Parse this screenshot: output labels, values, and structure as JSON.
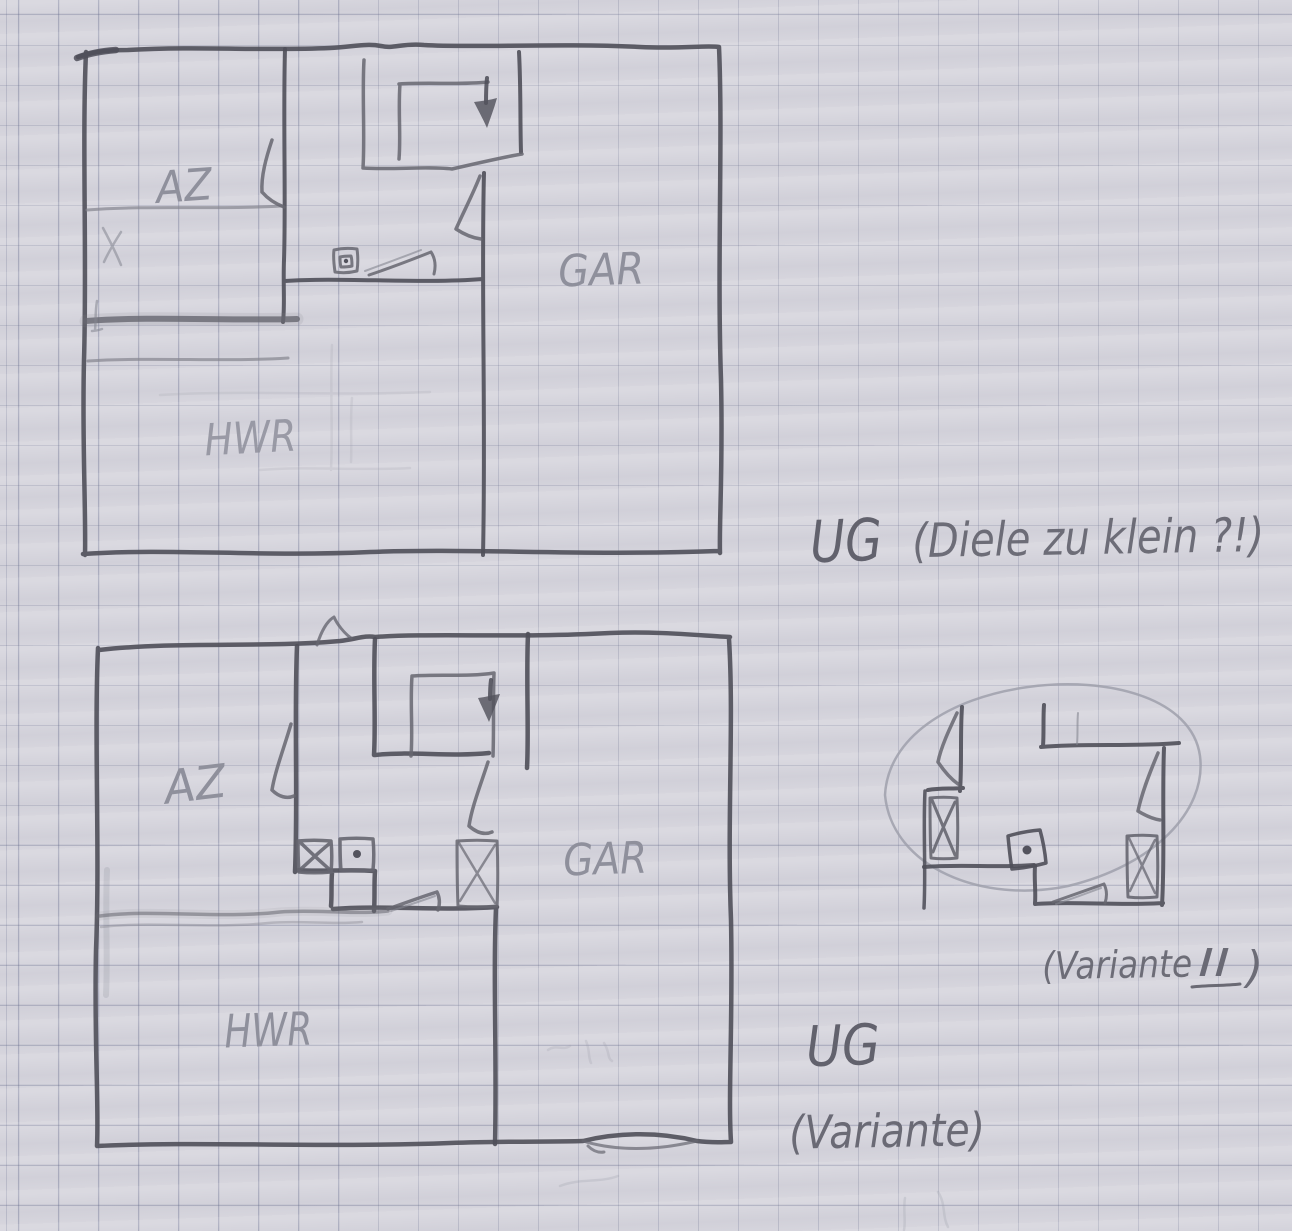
{
  "palette": {
    "paper": "#d6d5dd",
    "grid_line": "#666c8c",
    "pencil_dark": "#4f4f59",
    "pencil_medium": "#666670",
    "pencil_faint": "#9fa0ab"
  },
  "plan_top": {
    "rooms": {
      "az": "AZ",
      "gar": "GAR",
      "hwr": "HWR"
    },
    "caption": {
      "floor": "UG",
      "note": "(Diele zu klein ?!)"
    }
  },
  "plan_bottom": {
    "rooms": {
      "az": "AZ",
      "gar": "GAR",
      "hwr": "HWR"
    },
    "caption": {
      "floor": "UG",
      "note": "(Variante)"
    }
  },
  "detail_sketch": {
    "caption": {
      "prefix": "(Variante",
      "numeral": "II",
      "suffix": ")"
    }
  }
}
